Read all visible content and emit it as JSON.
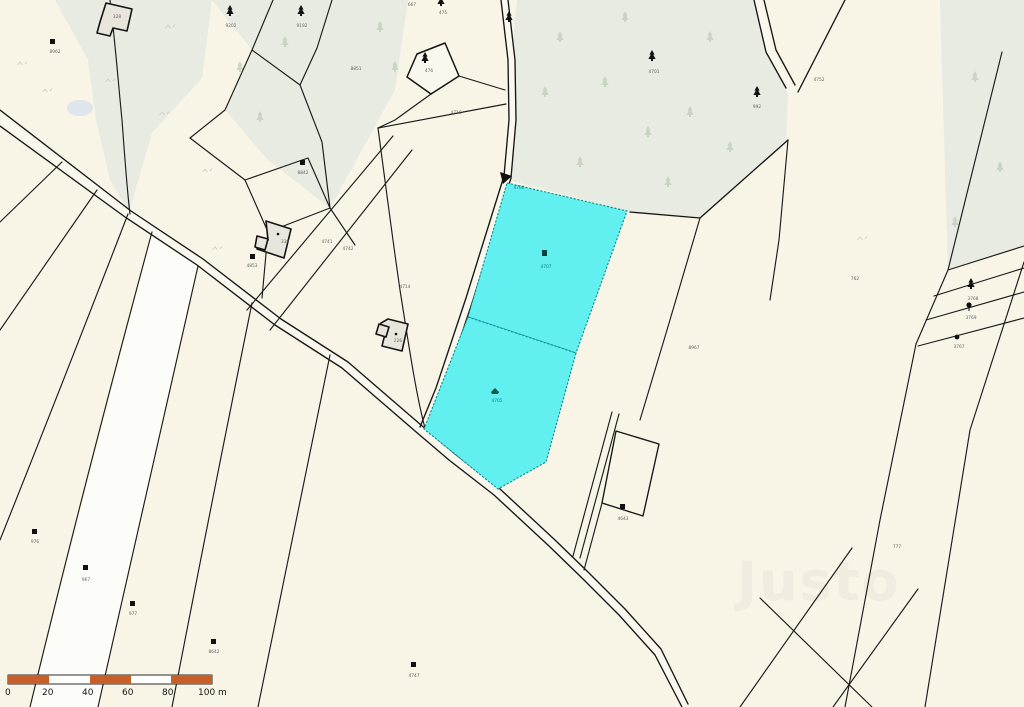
{
  "map": {
    "watermark": "Justo",
    "background_color": "#f8f4e6",
    "forest_color": "#e7ebe2",
    "highlight_color": "#62efef",
    "highlight_border": "#0a8c8c",
    "road_fill": "#faf7ee",
    "scale_bar": {
      "ticks": [
        "0",
        "20",
        "40",
        "60",
        "80",
        "100 m"
      ],
      "bar_color": "#c75f28",
      "unit": "m"
    },
    "parcel_labels": [
      {
        "label": "8962",
        "x": 55,
        "y": 53
      },
      {
        "label": "9202",
        "x": 231,
        "y": 27
      },
      {
        "label": "9192",
        "x": 302,
        "y": 27
      },
      {
        "label": "667",
        "x": 412,
        "y": 6
      },
      {
        "label": "475",
        "x": 443,
        "y": 14
      },
      {
        "label": "476",
        "x": 429,
        "y": 72
      },
      {
        "label": "8851",
        "x": 356,
        "y": 70
      },
      {
        "label": "4701",
        "x": 654,
        "y": 73
      },
      {
        "label": "992",
        "x": 757,
        "y": 108
      },
      {
        "label": "4752",
        "x": 819,
        "y": 81
      },
      {
        "label": "762",
        "x": 855,
        "y": 280
      },
      {
        "label": "8967",
        "x": 694,
        "y": 349
      },
      {
        "label": "8842",
        "x": 303,
        "y": 174
      },
      {
        "label": "4853",
        "x": 252,
        "y": 267
      },
      {
        "label": "4741",
        "x": 327,
        "y": 243
      },
      {
        "label": "4742",
        "x": 348,
        "y": 250
      },
      {
        "label": "4714",
        "x": 405,
        "y": 288
      },
      {
        "label": "4716",
        "x": 456,
        "y": 114
      },
      {
        "label": "328",
        "x": 117,
        "y": 18
      },
      {
        "label": "338",
        "x": 285,
        "y": 243
      },
      {
        "label": "226",
        "x": 398,
        "y": 342
      },
      {
        "label": "4700",
        "x": 519,
        "y": 189,
        "color": "#0a8080"
      },
      {
        "label": "4707",
        "x": 546,
        "y": 268,
        "color": "#0a7d7d"
      },
      {
        "label": "4705",
        "x": 497,
        "y": 402,
        "color": "#0a7d7d"
      },
      {
        "label": "4643",
        "x": 623,
        "y": 520
      },
      {
        "label": "976",
        "x": 35,
        "y": 543
      },
      {
        "label": "967",
        "x": 86,
        "y": 581
      },
      {
        "label": "977",
        "x": 133,
        "y": 615
      },
      {
        "label": "8642",
        "x": 214,
        "y": 653
      },
      {
        "label": "4747",
        "x": 414,
        "y": 677
      },
      {
        "label": "777",
        "x": 897,
        "y": 548
      },
      {
        "label": "3768",
        "x": 973,
        "y": 300
      },
      {
        "label": "3769",
        "x": 971,
        "y": 319
      },
      {
        "label": "3767",
        "x": 959,
        "y": 348
      }
    ]
  }
}
